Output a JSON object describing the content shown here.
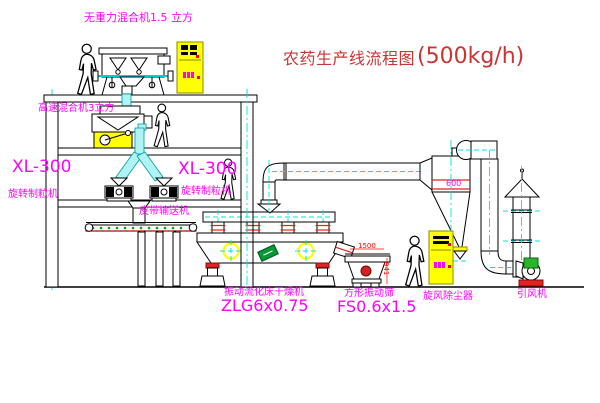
{
  "title": {
    "text": "农药生产线流程图",
    "capacity": "(500kg/h)"
  },
  "equipment_labels": {
    "top_mixer": "无重力混合机1.5 立方",
    "high_speed_mixer": "高速混合机3立方",
    "granulator_left": {
      "model": "XL-300",
      "name": "旋转制粒机"
    },
    "granulator_right": {
      "model": "XL-300",
      "name": "旋转制粒机"
    },
    "belt_conveyor": "皮带输送机",
    "fluid_bed_dryer": {
      "name": "振动流化床干燥机",
      "model": "ZLG6x0.75"
    },
    "vibrating_screen": {
      "name": "方形振动筛",
      "model": "FS0.6x1.5"
    },
    "cyclone": {
      "name": "旋风除尘器",
      "size": "600"
    },
    "induced_draft_fan": "引风机"
  },
  "dimensions": {
    "screen_length": "1500",
    "screen_height": "941"
  },
  "colors": {
    "label_magenta": "#ff00ff",
    "title_red": "#cc3333",
    "dimension_red": "#ff0000",
    "centerline_cyan": "#00e0e0",
    "cabinet_yellow": "#ffff00",
    "motor_green": "#2ab52a",
    "logo_green": "#009933"
  }
}
